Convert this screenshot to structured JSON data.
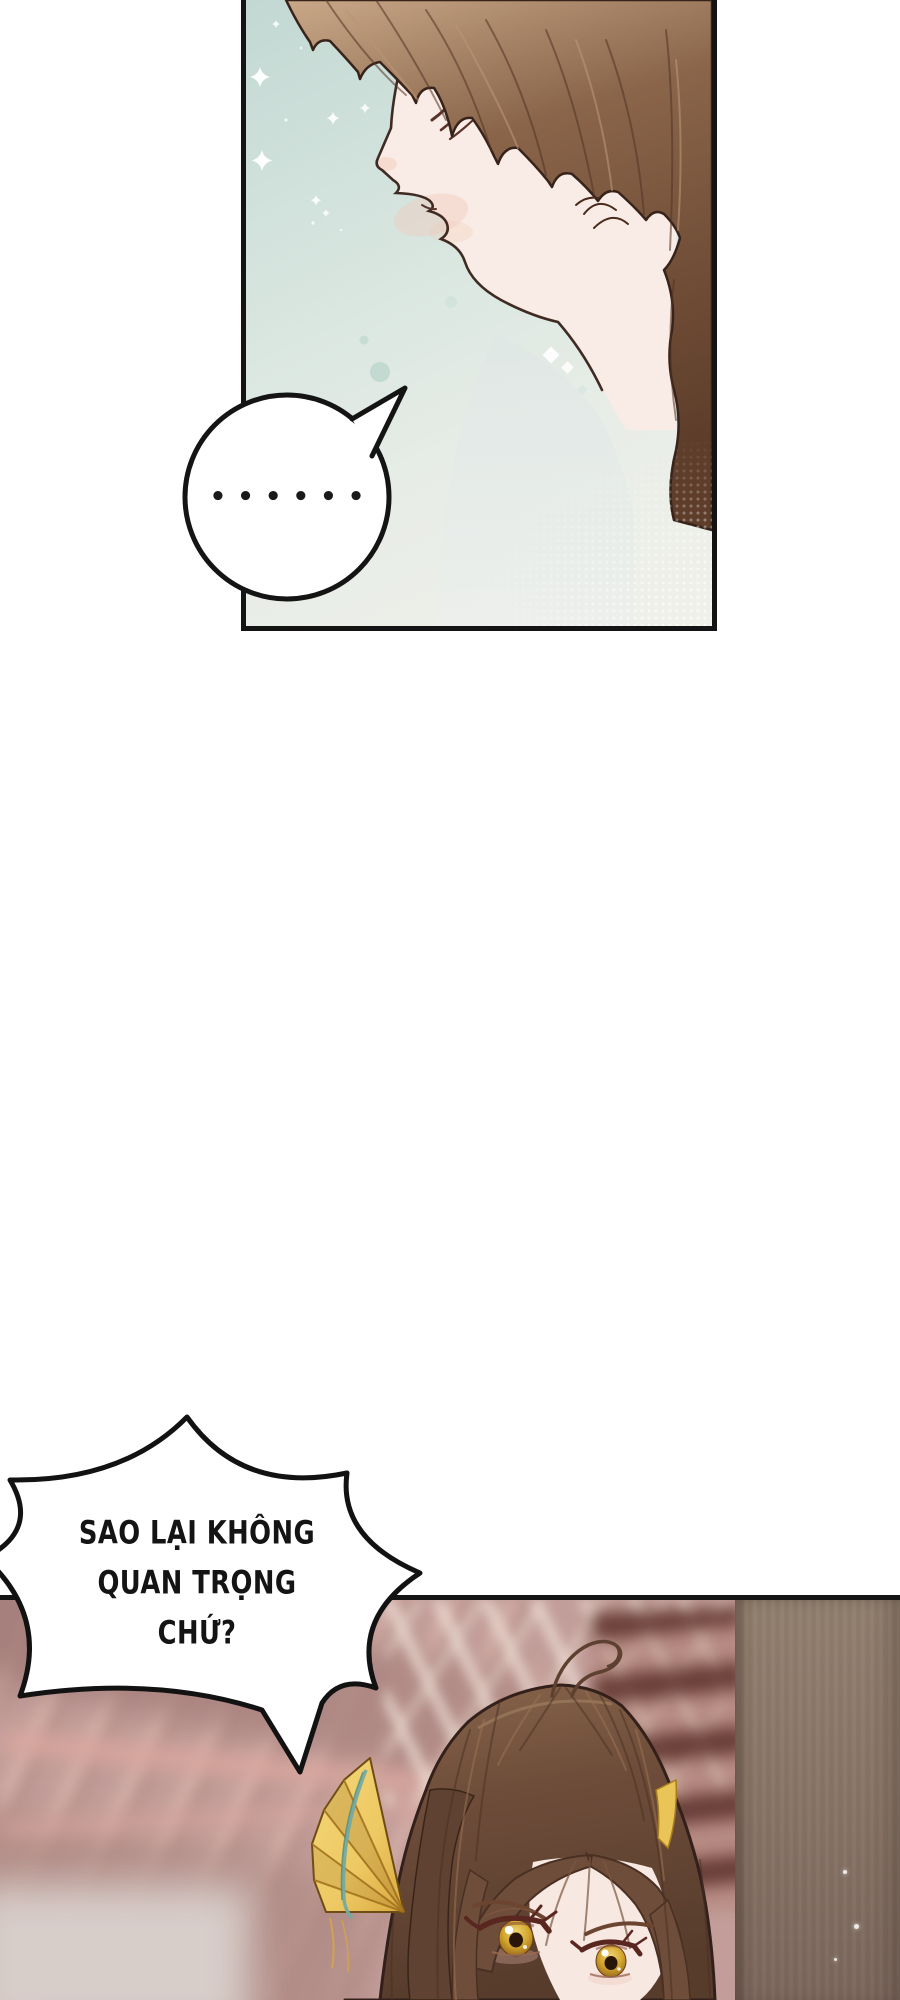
{
  "bubbles": {
    "ellipsis": {
      "text": "••••••"
    },
    "shout": {
      "lines": [
        "SAO LẠI KHÔNG",
        "QUAN TRỌNG",
        "CHỨ?"
      ]
    }
  },
  "colors": {
    "panel_border": "#141414",
    "top_bg_teal": "#c3d8d3",
    "top_bg_light": "#f0f0ea",
    "hair_top_highlight": "#c9a888",
    "hair_top_base": "#7e5a41",
    "hair_top_dark": "#5e3e2b",
    "skin": "#f9ece6",
    "blush": "#f3c9b8",
    "line_brown": "#3f2b22",
    "bubble_fill": "#ffffff",
    "text_black": "#1a1a1a",
    "bottom_bg_rose": "#c29d99",
    "bottom_bg_dark_rose": "#a7807d",
    "stair_brown": "#6f4138",
    "pillar_grey": "#8a776f",
    "girl_hair_base": "#6e4d3a",
    "girl_hair_dark": "#4a3023",
    "girl_hair_light": "#a5805f",
    "girl_skin": "#f7e8e2",
    "iris_gold": "#d3a62e",
    "fan_gold": "#eec963",
    "fan_teal": "#74aaa2",
    "sparkle_white": "#ffffff"
  }
}
